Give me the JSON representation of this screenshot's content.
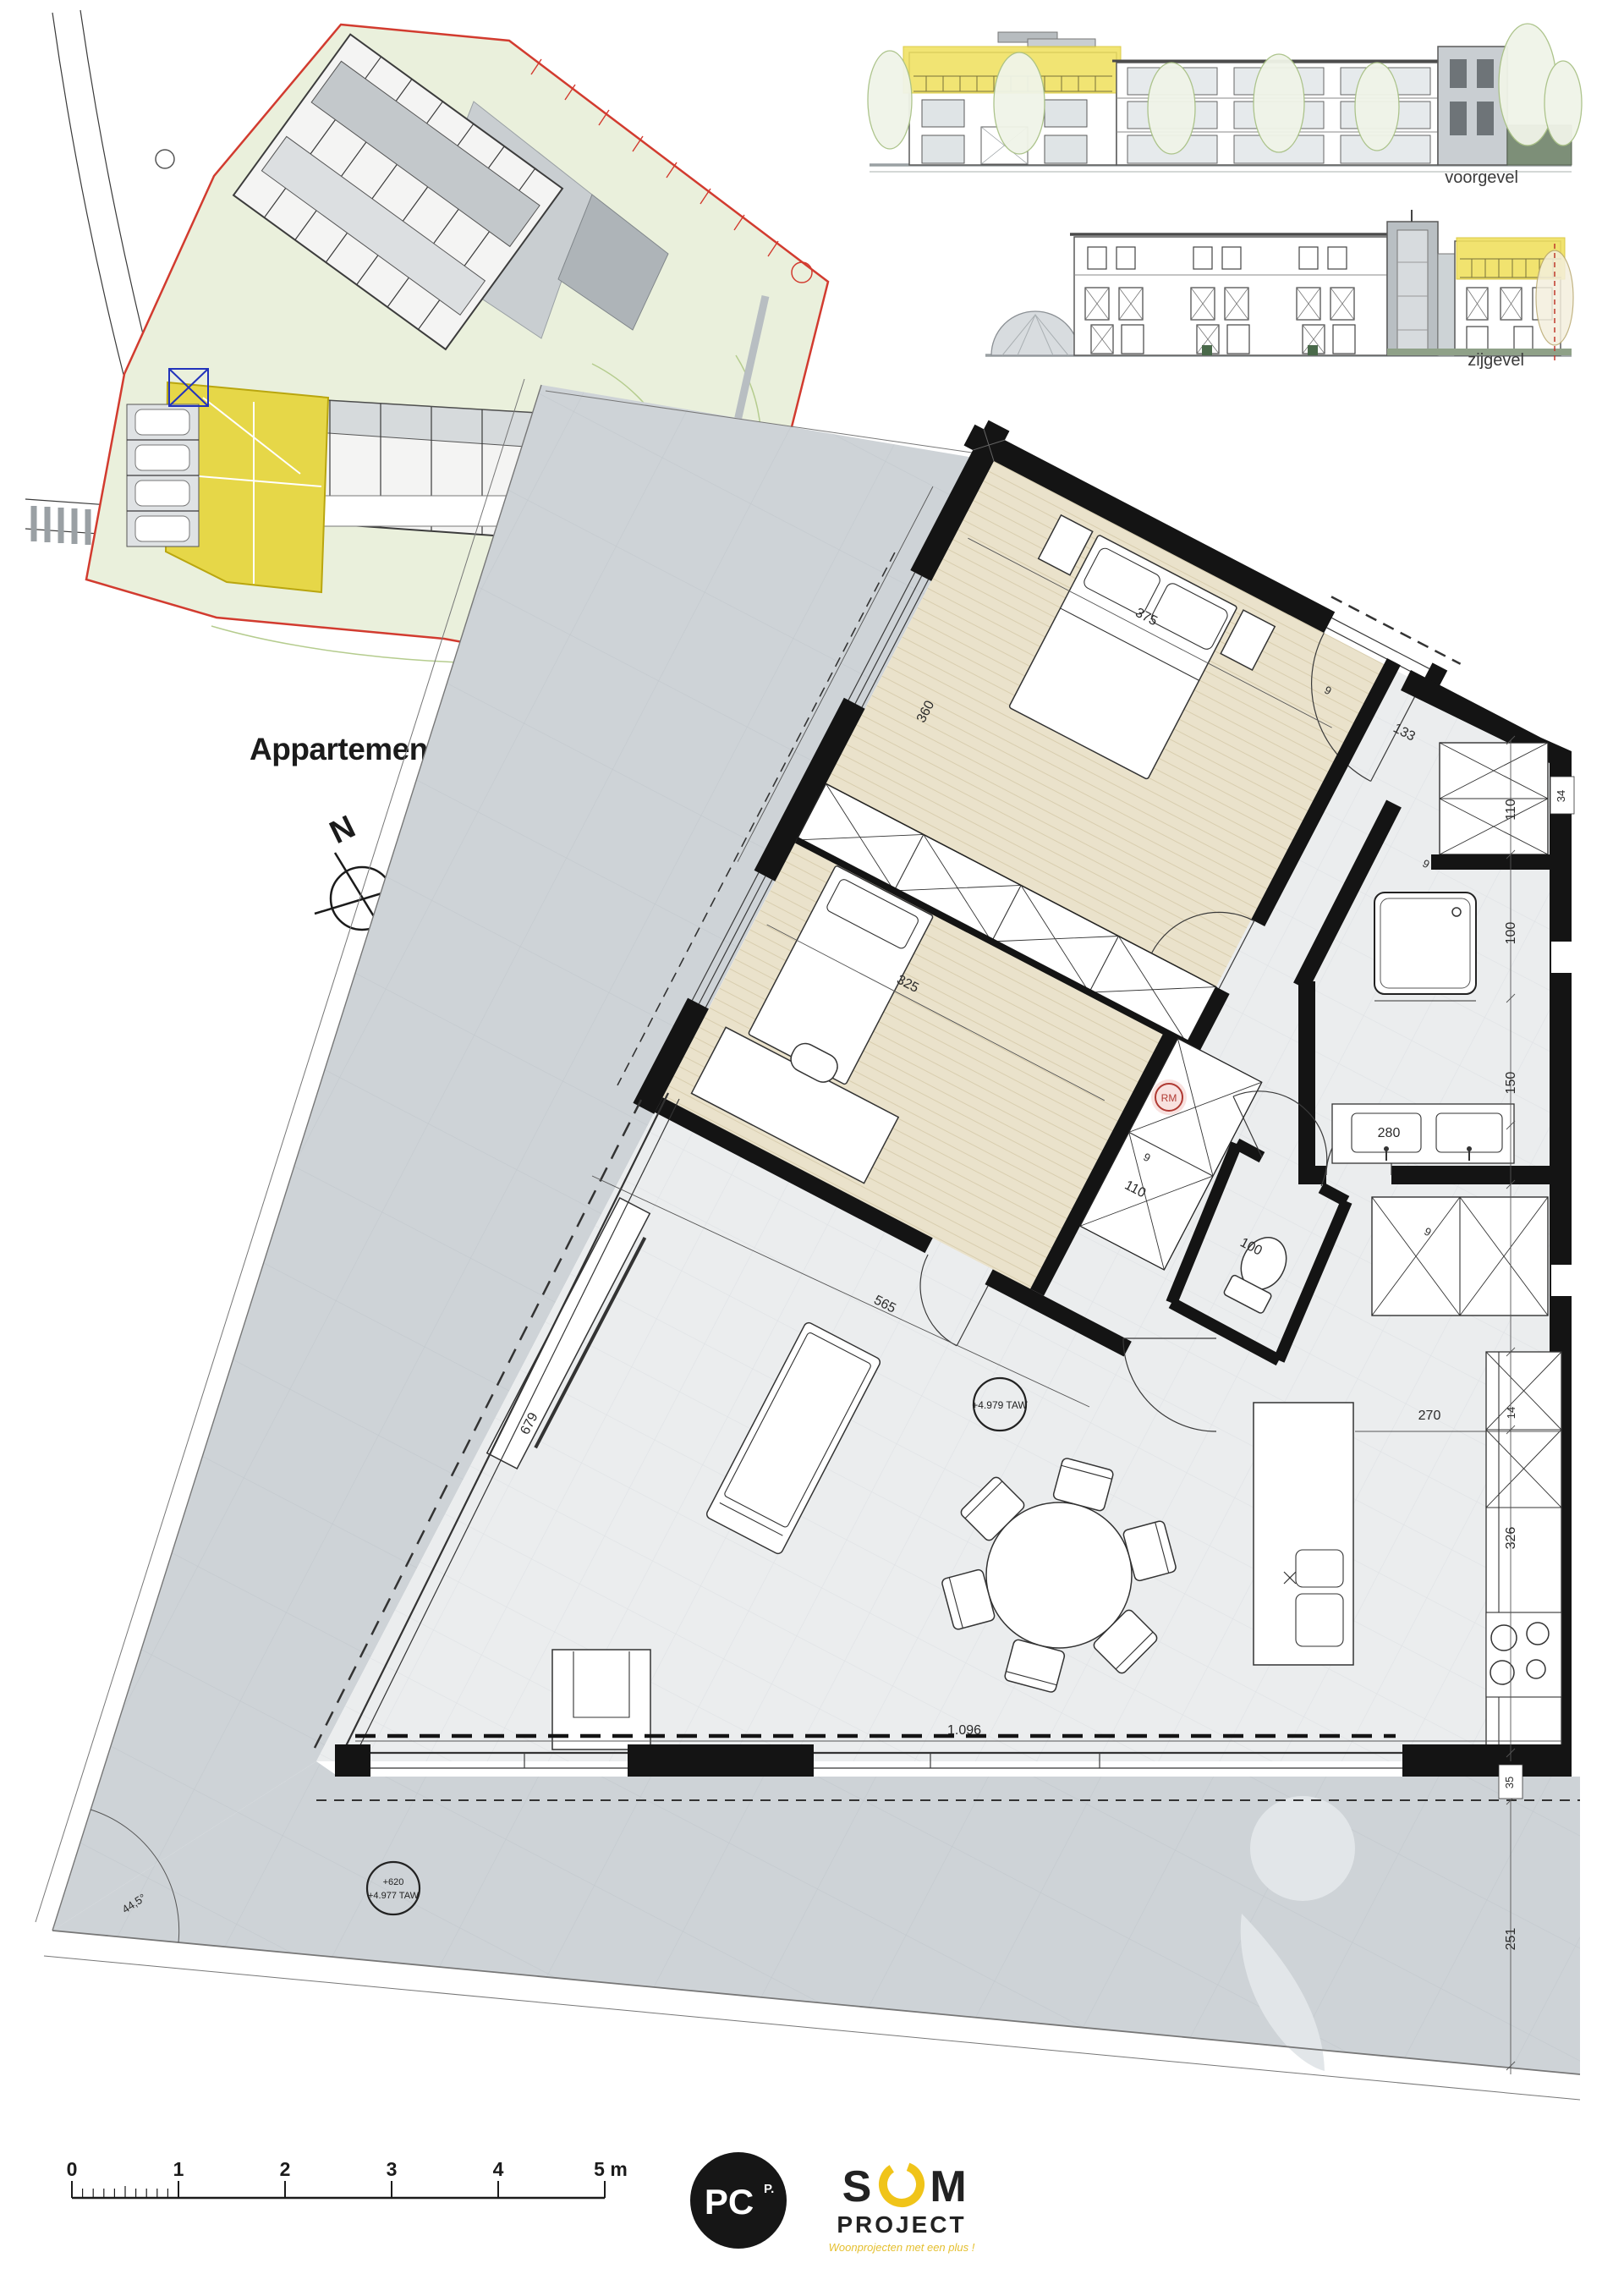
{
  "title": {
    "text": "Appartement 2.1"
  },
  "compass": {
    "label": "N"
  },
  "elevations": {
    "front": "voorgevel",
    "side": "zijgevel"
  },
  "plan": {
    "annotations": {
      "smoke_detector": "RM",
      "level_interior": "+4.979 TAW",
      "level_terrace_line1": "+620",
      "level_terrace_line2": "+4.977 TAW",
      "corner_angle": "44,5°"
    },
    "dims": [
      {
        "v": "360"
      },
      {
        "v": "375"
      },
      {
        "v": "325"
      },
      {
        "v": "133"
      },
      {
        "v": "565"
      },
      {
        "v": "1.096"
      },
      {
        "v": "679"
      },
      {
        "v": "270"
      },
      {
        "v": "326"
      },
      {
        "v": "150"
      },
      {
        "v": "100"
      },
      {
        "v": "280"
      },
      {
        "v": "110"
      },
      {
        "v": "110"
      },
      {
        "v": "100"
      },
      {
        "v": "34"
      },
      {
        "v": "35"
      },
      {
        "v": "251"
      },
      {
        "v": "14"
      },
      {
        "v": "9"
      },
      {
        "v": "9"
      },
      {
        "v": "9"
      },
      {
        "v": "9"
      }
    ]
  },
  "scalebar": {
    "labels": [
      "0",
      "1",
      "2",
      "3",
      "4",
      "5 m"
    ]
  },
  "logos": {
    "pc": {
      "main": "PC",
      "sup": "P."
    },
    "som": {
      "s": "S",
      "m": "M",
      "project": "PROJECT",
      "tagline": "Woonprojecten met een plus !"
    }
  }
}
